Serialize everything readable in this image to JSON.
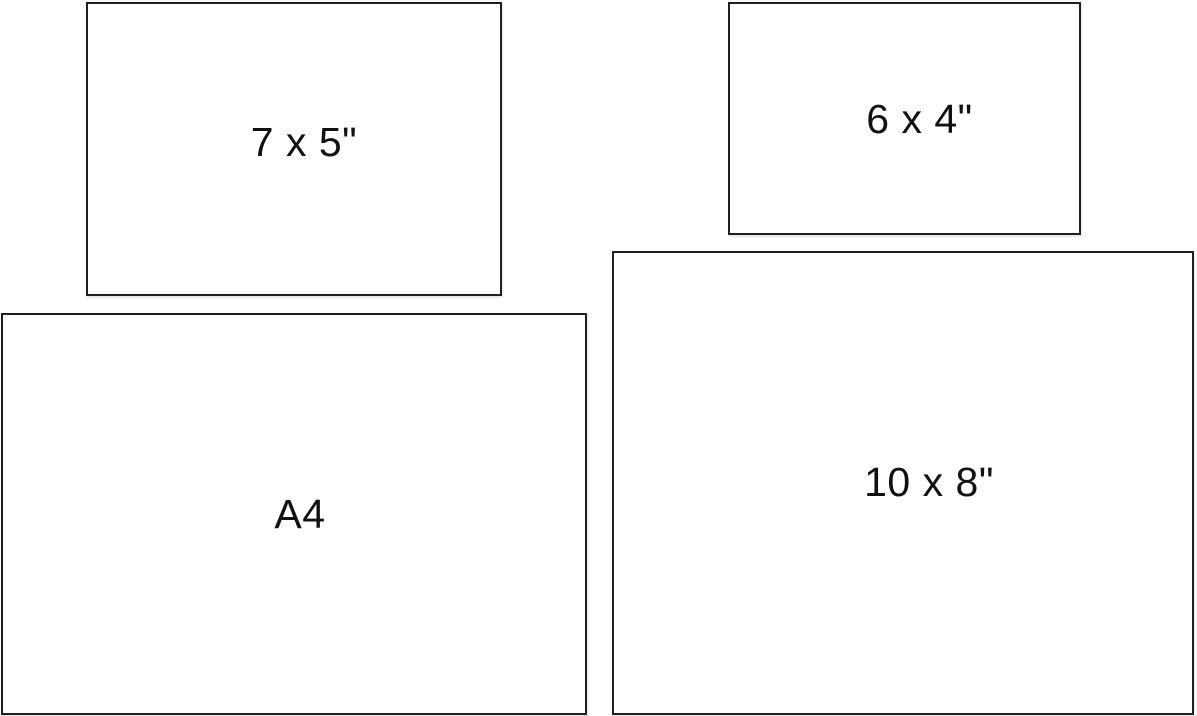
{
  "diagram": {
    "description": "Comparison of print/paper sizes shown as outlined rectangles",
    "background_color": "#ffffff",
    "border_color": "#1f1f1f",
    "text_color": "#111111"
  },
  "papers": [
    {
      "id": "7x5",
      "label": "7 x 5\""
    },
    {
      "id": "6x4",
      "label": "6 x 4\""
    },
    {
      "id": "a4",
      "label": "A4"
    },
    {
      "id": "10x8",
      "label": "10 x 8\""
    }
  ]
}
